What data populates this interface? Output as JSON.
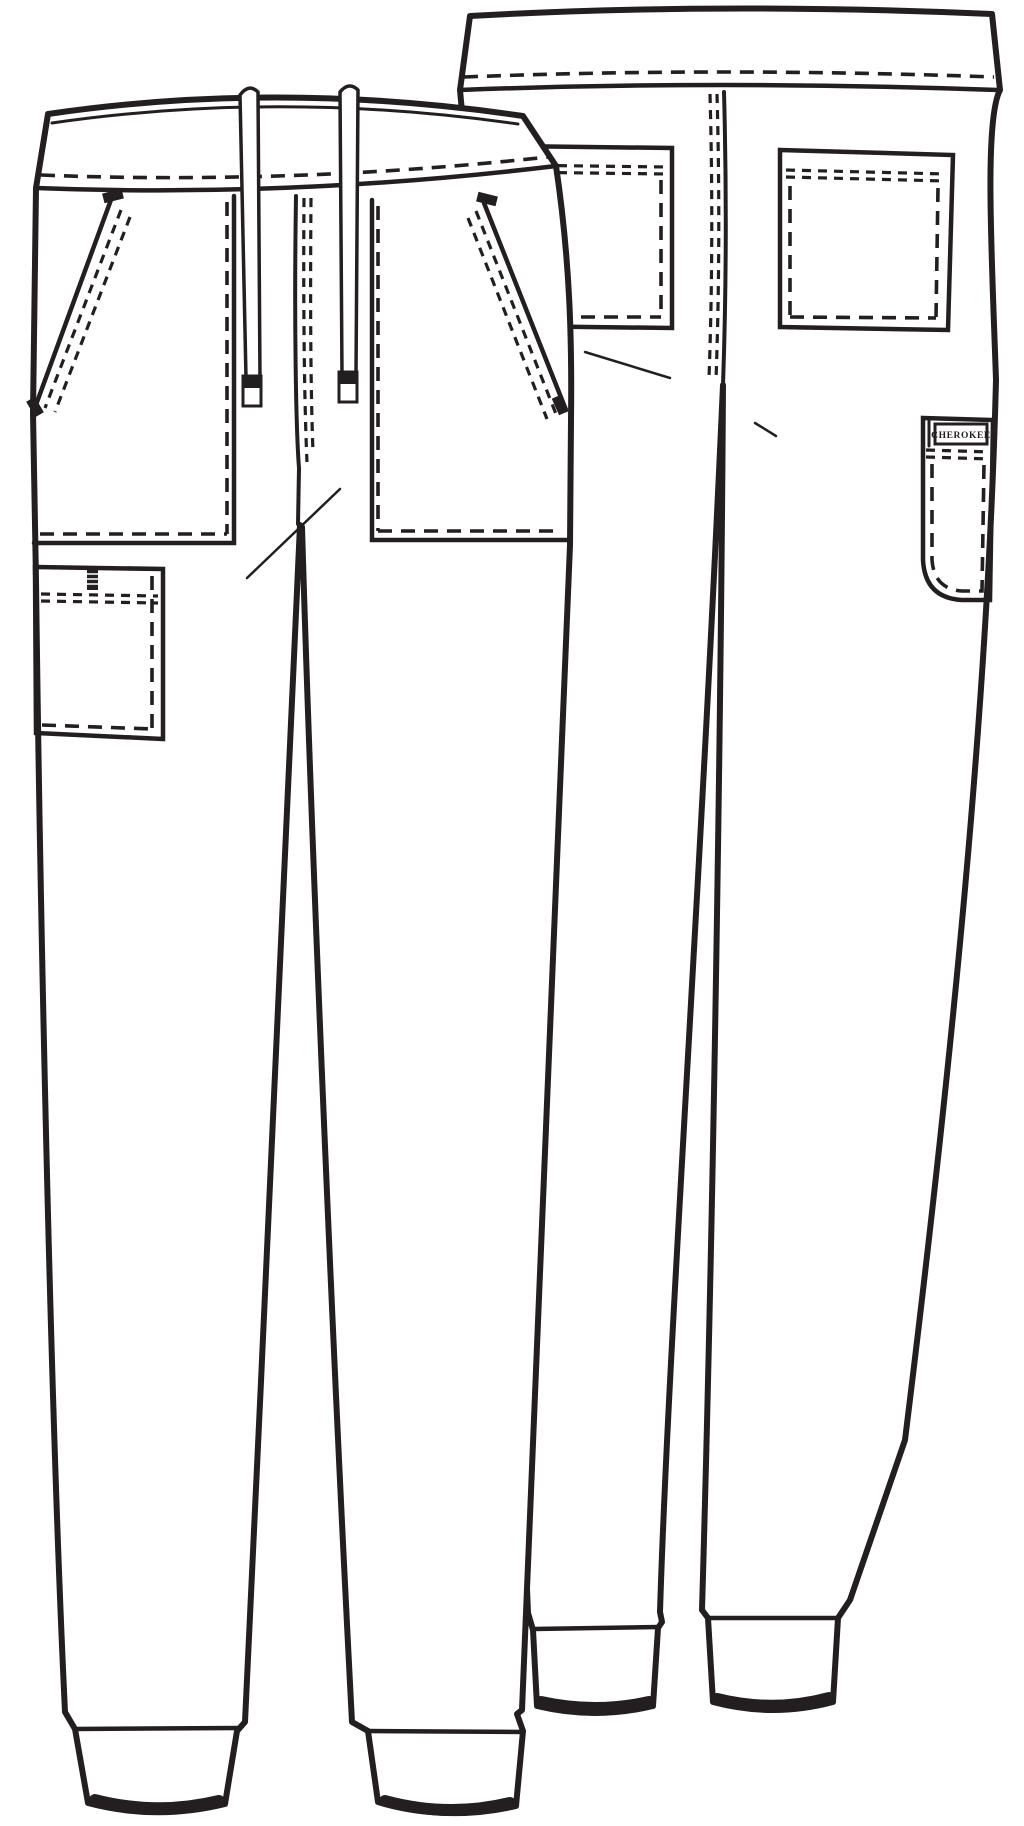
{
  "artwork": {
    "kind": "garment-technical-flat-sketch",
    "garment": "jogger scrub pants with drawstring waistband, slash pockets, cargo pockets and rib-knit cuffs",
    "brand_label": "CHEROKEE",
    "colors": {
      "line": "#231f20",
      "background": "#ffffff"
    },
    "views": [
      {
        "id": "front-view",
        "description": "front flat view with drawstring waist, slanted front pockets, left-leg cargo pocket, ribbed ankle cuffs"
      },
      {
        "id": "back-view",
        "description": "back flat view with two patch pockets, center back seam, branded side cargo pocket, ribbed ankle cuffs"
      }
    ]
  }
}
